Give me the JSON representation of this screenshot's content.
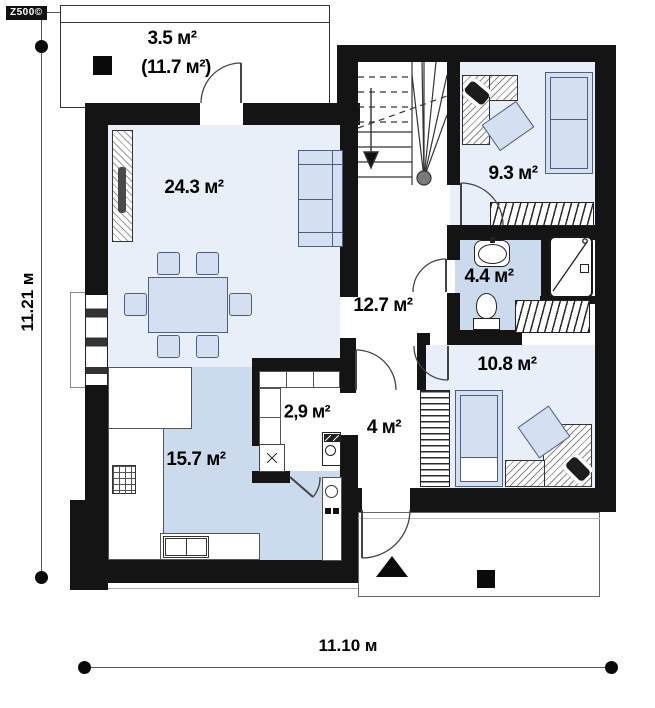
{
  "logo": {
    "text": "Z500©"
  },
  "dimensions": {
    "left": "11.21 м",
    "bottom": "11.10 м"
  },
  "terrace": {
    "area": "3.5 м²",
    "area_total": "(11.7 м²)"
  },
  "rooms": {
    "living": {
      "area": "24.3 м²"
    },
    "kitchen": {
      "area": "15.7 м²"
    },
    "pantry": {
      "area": "2,9 м²"
    },
    "hallway": {
      "area": "12.7 м²"
    },
    "entry": {
      "area": "4 м²"
    },
    "bathroom": {
      "area": "4.4 м²"
    },
    "bedroom_upper": {
      "area": "9.3 м²"
    },
    "bedroom_lower": {
      "area": "10.8 м²"
    }
  },
  "colors": {
    "wall": "#141414",
    "floor-light": "#e9eff8",
    "floor-dark": "#ccdaed",
    "furniture-fill": "#d4e0f1",
    "furniture-stroke": "#4d5d7a",
    "glazing-gray": "#9b9b9b",
    "line": "#444444"
  }
}
